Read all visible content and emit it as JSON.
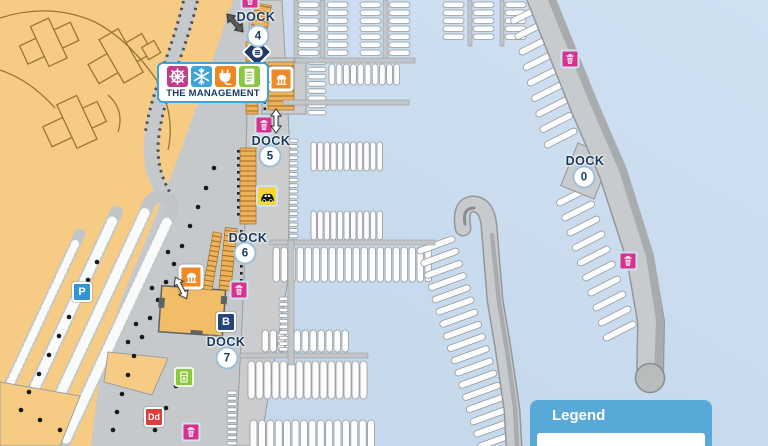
{
  "map_title": "marina-map",
  "docks": [
    {
      "label": "DOCK",
      "number": "4",
      "tx": 256,
      "ty": 17,
      "cx": 258,
      "cy": 36
    },
    {
      "label": "DOCK",
      "number": "5",
      "tx": 271,
      "ty": 141,
      "cx": 270,
      "cy": 156
    },
    {
      "label": "DOCK",
      "number": "6",
      "tx": 248,
      "ty": 238,
      "cx": 245,
      "cy": 253
    },
    {
      "label": "DOCK",
      "number": "7",
      "tx": 226,
      "ty": 342,
      "cx": 227,
      "cy": 358
    },
    {
      "label": "DOCK",
      "number": "0",
      "tx": 585,
      "ty": 161,
      "cx": 584,
      "cy": 177
    }
  ],
  "management": {
    "label": "THE MANAGEMENT",
    "icons": [
      {
        "name": "helm-icon",
        "color": "#c13e8c"
      },
      {
        "name": "snowflake-icon",
        "color": "#3fa5d9"
      },
      {
        "name": "power-plug-icon",
        "color": "#f0861f"
      },
      {
        "name": "document-icon",
        "color": "#8dc63f"
      }
    ]
  },
  "legend": {
    "title": "Legend"
  },
  "colors": {
    "water": "#c9dcee",
    "land": "#f6cc85",
    "promenade": "#c6c9cc",
    "pier": "#caccce",
    "slip": "#fdfdfd",
    "navy_text": "#16395f",
    "accent_blue": "#3fa5d9",
    "trash_pink": "#d9318e",
    "pavilion_orange": "#f08a26",
    "vending_green": "#8dc63f",
    "taxi_yellow": "#f6d829",
    "parking_blue": "#2f96d3",
    "launch_navy": "#24447c",
    "dd_red": "#d8403c",
    "legend_blue": "#58a8d8"
  },
  "markers": [
    {
      "type": "trash",
      "name": "trash-icon",
      "x": 250,
      "y": 0
    },
    {
      "type": "trash",
      "name": "trash-icon",
      "x": 264,
      "y": 125
    },
    {
      "type": "trash",
      "name": "trash-icon",
      "x": 239,
      "y": 290
    },
    {
      "type": "trash",
      "name": "trash-icon",
      "x": 191,
      "y": 432
    },
    {
      "type": "trash",
      "name": "trash-icon",
      "x": 570,
      "y": 59
    },
    {
      "type": "trash",
      "name": "trash-icon",
      "x": 628,
      "y": 261
    },
    {
      "type": "taxi",
      "name": "taxi-icon",
      "x": 267,
      "y": 196
    },
    {
      "type": "badge",
      "name": "boat-launch-badge",
      "label": "B",
      "color": "#24447c",
      "x": 226,
      "y": 322
    },
    {
      "type": "badge",
      "name": "parking-badge",
      "label": "P",
      "color": "#2f96d3",
      "x": 82,
      "y": 292
    },
    {
      "type": "badge",
      "name": "dd-badge",
      "label": "Dd",
      "color": "#d8403c",
      "x": 154,
      "y": 417,
      "small": true
    },
    {
      "type": "vending",
      "name": "vending-machine-icon",
      "x": 184,
      "y": 377
    },
    {
      "type": "pavilion",
      "name": "fuel-dock-icon",
      "x": 281,
      "y": 79
    },
    {
      "type": "pavilion",
      "name": "pavilion-icon",
      "x": 191,
      "y": 277
    },
    {
      "type": "pumpout",
      "name": "pump-out-icon",
      "x": 257,
      "y": 52
    },
    {
      "type": "arrow2",
      "name": "two-way-arrow-icon",
      "x": 276,
      "y": 121,
      "rot": 0
    },
    {
      "type": "arrow2",
      "name": "two-way-arrow-icon",
      "x": 181,
      "y": 288,
      "rot": -28
    },
    {
      "type": "arrow2",
      "name": "two-way-arrow-icon",
      "x": 235,
      "y": 23,
      "rot": -42,
      "dark": true
    },
    {
      "type": "arrowR",
      "name": "management-arrow-icon",
      "x": 263,
      "y": 82
    }
  ]
}
